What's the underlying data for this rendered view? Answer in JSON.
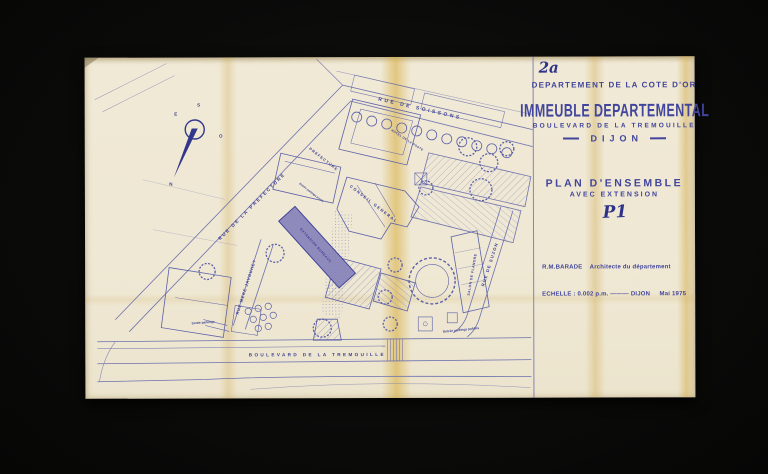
{
  "colors": {
    "background": "#0b0b0a",
    "paper": "#efe8d4",
    "ink_text": "#41459c",
    "ink_line": "#5c60a8",
    "fold_stain": "#d6aa37",
    "extension_fill": "#8e8abc"
  },
  "annotations": {
    "sheet_number": "2a",
    "sheet_code": "P1"
  },
  "title_block": {
    "department": "DEPARTEMENT DE LA COTE D'OR",
    "building_title": "IMMEUBLE DEPARTEMENTAL",
    "address": "BOULEVARD DE LA TREMOUILLE",
    "city": "DIJON",
    "plan_title": "PLAN D'ENSEMBLE",
    "plan_subtitle": "AVEC EXTENSION",
    "architect_line": "R.M.BARADE    Architecte du département",
    "scale_line": "ECHELLE : 0.002 p.m. ——— DIJON     Mai 1975"
  },
  "map": {
    "street_labels": [
      {
        "id": "rue-de-soissons",
        "label": "RUE DE SOISSONS"
      },
      {
        "id": "rue-de-la-prefecture",
        "label": "RUE DE LA PREFECTURE"
      },
      {
        "id": "rue-mere-javouhey",
        "label": "RUE MERE JAVOUHEY"
      },
      {
        "id": "rue-de-suzon",
        "label": "RUE DE SUZON"
      },
      {
        "id": "boulevard-de-la-tremouille",
        "label": "BOULEVARD DE LA TREMOUILLE"
      }
    ],
    "building_labels": [
      {
        "id": "hotel-de-la-poste",
        "label": "HOTEL DE LA POSTE"
      },
      {
        "id": "prefecture",
        "label": "PREFECTURE"
      },
      {
        "id": "conseil-general",
        "label": "CONSEIL GENERAL"
      },
      {
        "id": "extension",
        "label": "EXTENSION BUREAUX"
      },
      {
        "id": "salon-de-flandre",
        "label": "SALON DE FLANDRE"
      }
    ],
    "site_labels": [
      {
        "id": "sortie-parkings",
        "label": "Sortie parkings"
      },
      {
        "id": "entree-parkings-prives",
        "label": "Entrée parkings privés"
      },
      {
        "id": "entree-parkings-publics",
        "label": "Entrée parkings publics"
      }
    ],
    "compass": {
      "top": "S",
      "left": "E",
      "right": "O",
      "needle": "N"
    }
  }
}
